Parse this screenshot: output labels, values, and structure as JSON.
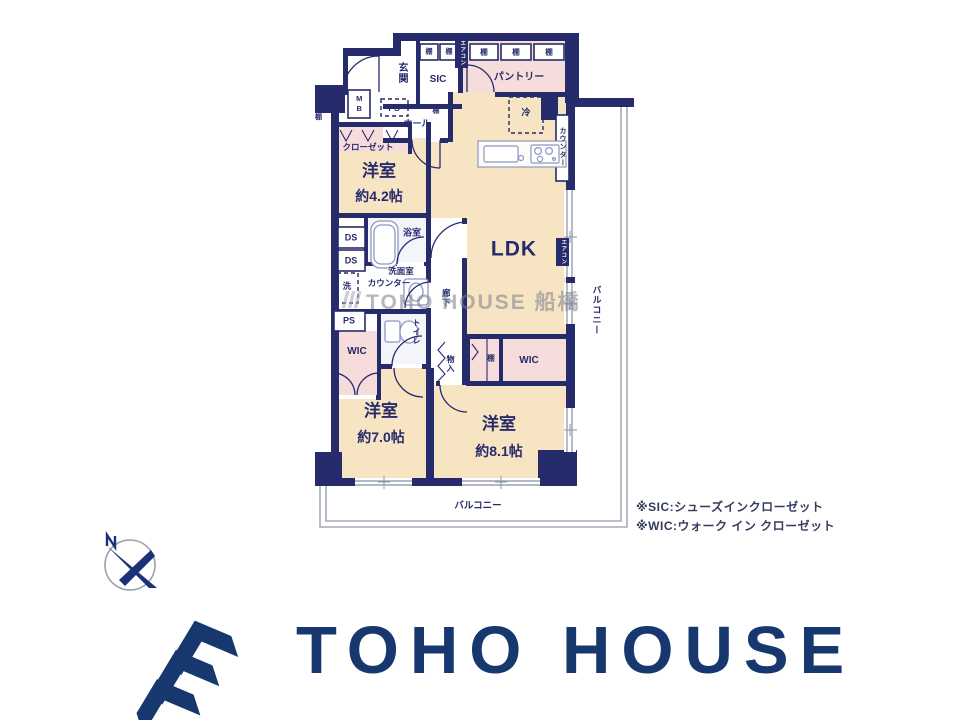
{
  "plan": {
    "entrance": {
      "genkan": "玄関",
      "sic": "SIC",
      "mb": "MB",
      "ps": "PS",
      "hall": "ホール"
    },
    "shelf": "棚",
    "pantry": {
      "label": "パントリー",
      "fridge": "冷"
    },
    "ldk": {
      "label": "LDK",
      "counter": "カウンター",
      "aircon": "エアコン"
    },
    "west_room": {
      "label": "洋室",
      "size": "約4.2帖",
      "closet": "クローゼット"
    },
    "wet": {
      "ds": "DS",
      "bath": "浴室",
      "wash_room": "洗面室",
      "wash_counter": "カウンター",
      "laundry": "洗",
      "ps": "PS",
      "toilet": "トイレ"
    },
    "corridor": {
      "label": "廊下",
      "storage": "物入"
    },
    "wic_left": "WIC",
    "wic_right": "WIC",
    "room70": {
      "label": "洋室",
      "size": "約7.0帖"
    },
    "room81": {
      "label": "洋室",
      "size": "約8.1帖"
    },
    "balcony_bottom": "バルコニー",
    "balcony_right": "バルコニー"
  },
  "notes": {
    "sic": "※SIC:シューズインクローゼット",
    "wic": "※WIC:ウォーク イン クローゼット"
  },
  "watermark": "TOHO HOUSE 船橋",
  "logo": {
    "text": "TOHO HOUSE"
  },
  "colors": {
    "wall": "#262b6b",
    "room": "#f7e4c3",
    "closet_pink": "#f7dcdc",
    "logo_navy": "#16386e"
  }
}
